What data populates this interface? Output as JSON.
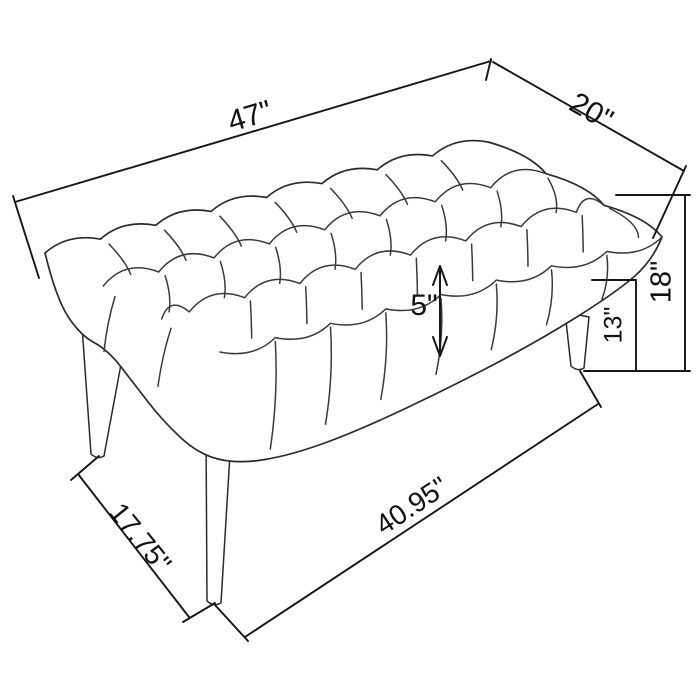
{
  "page": {
    "background": "#ffffff"
  },
  "drawing": {
    "subject": "tufted bench dimension line drawing",
    "line_color": "#3a3a3a",
    "outline_color": "#2b2b2b",
    "dimension_line_color": "#161616",
    "label_color": "#111111",
    "units": "inches",
    "dimensions": {
      "top_length": {
        "label": "47\"",
        "value": 47
      },
      "top_depth": {
        "label": "20\"",
        "value": 20
      },
      "overall_height": {
        "label": "18\"",
        "value": 18
      },
      "leg_height": {
        "label": "13\"",
        "value": 13
      },
      "seat_thickness": {
        "label": "5\"",
        "value": 5
      },
      "leg_span_depth": {
        "label": "17.75\"",
        "value": 17.75
      },
      "leg_span_length": {
        "label": "40.95\"",
        "value": 40.95
      }
    }
  }
}
